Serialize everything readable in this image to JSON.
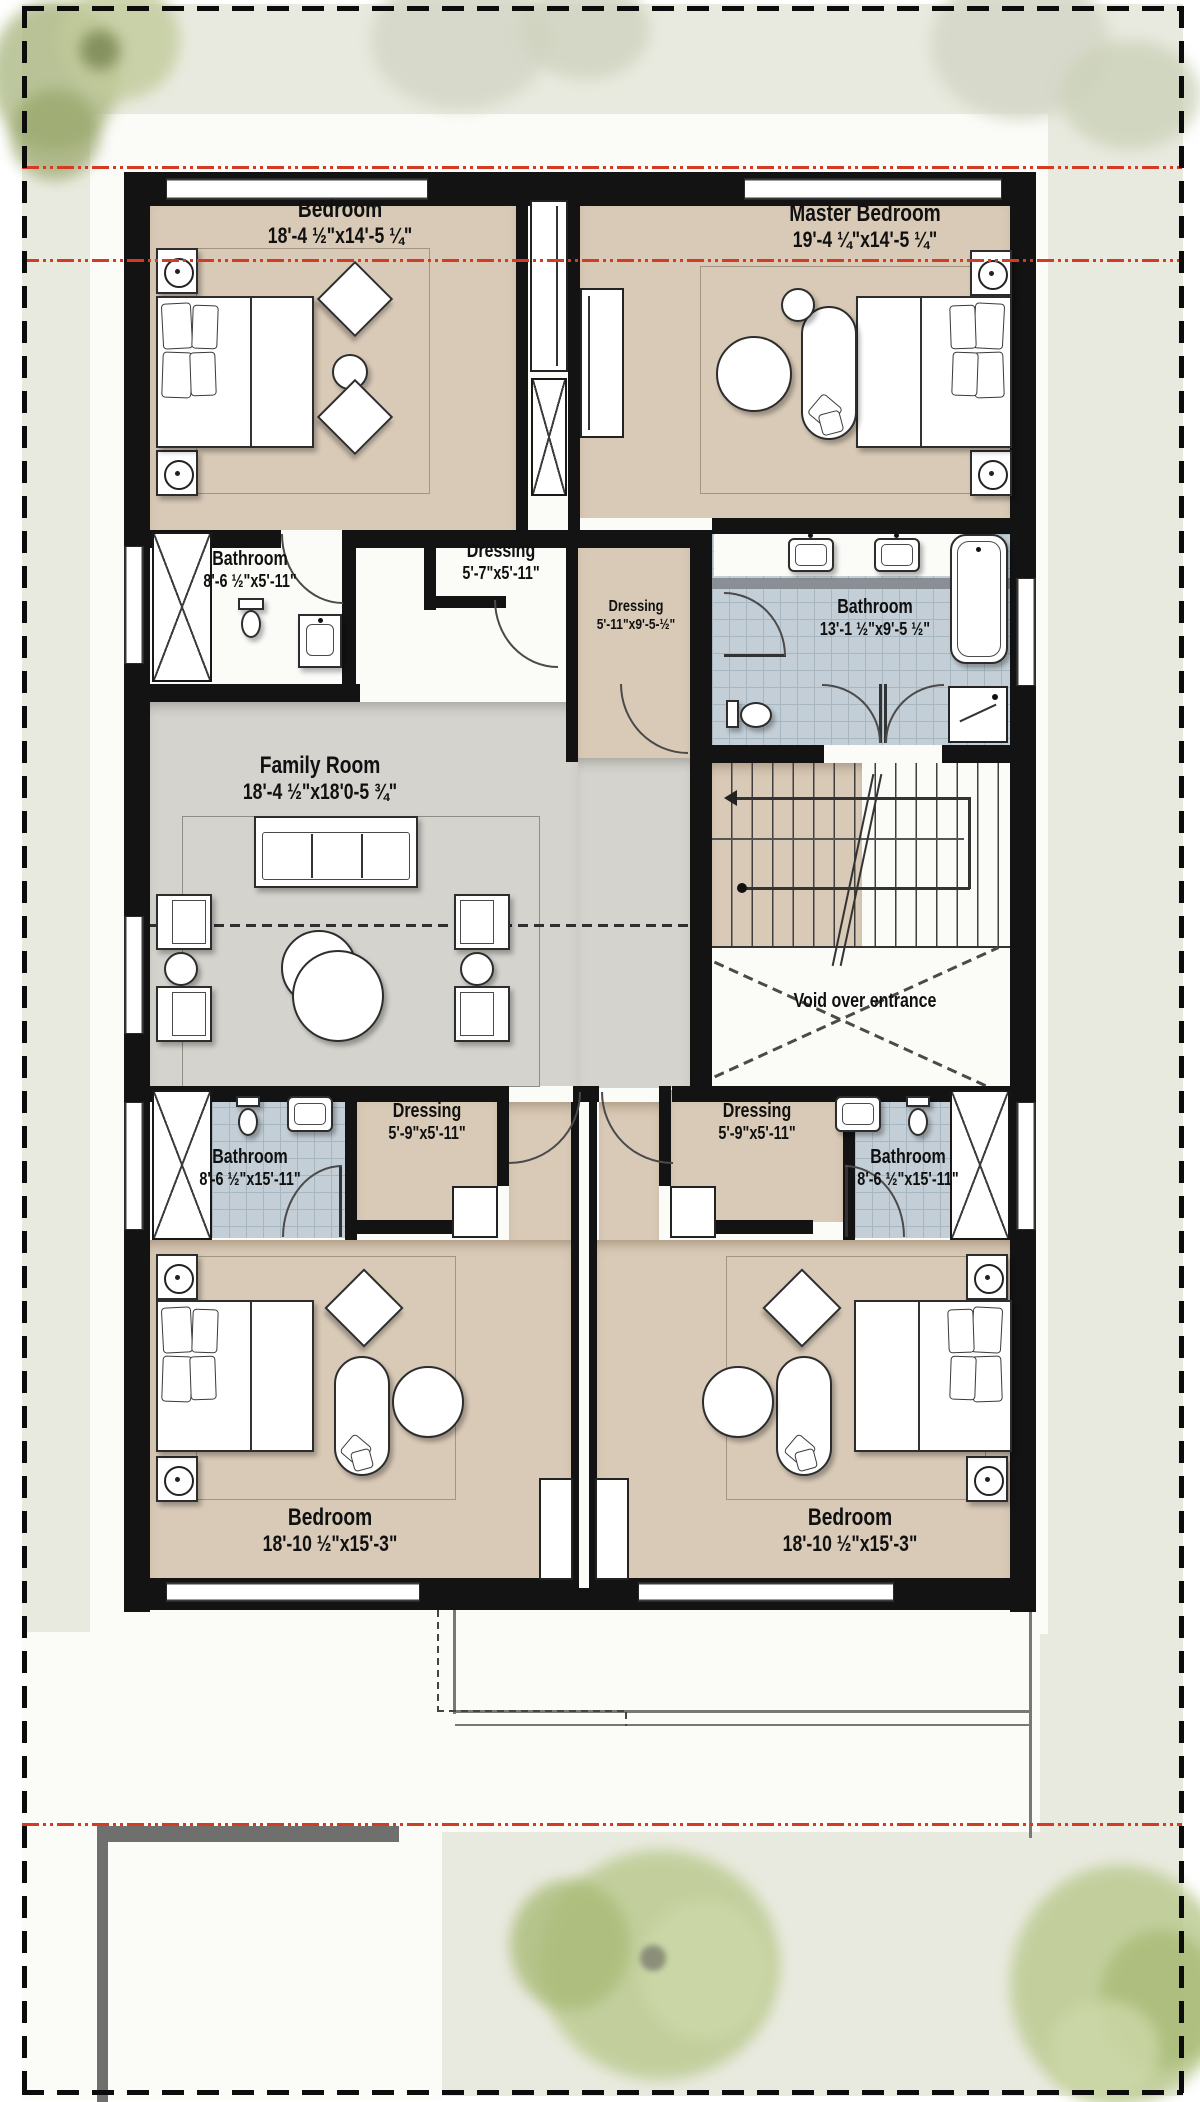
{
  "colors": {
    "wall": "#131313",
    "floor_tan": "#d9cab7",
    "floor_gray": "#d5d3cd",
    "bathroom_tile": "#c3ced6",
    "section_line_red": "#d53a23",
    "tree_green": "#b9c88f",
    "paper": "#e9eadf"
  },
  "rooms": {
    "bedroom_tl": {
      "name": "Bedroom",
      "dims": "18'-4 ½\"x14'-5 ¼\""
    },
    "master": {
      "name": "Master Bedroom",
      "dims": "19'-4 ¼\"x14'-5 ¼\""
    },
    "bath_tl": {
      "name": "Bathroom",
      "dims": "8'-6 ½\"x5'-11\""
    },
    "dressing_top": {
      "name": "Dressing",
      "dims": "5'-7\"x5'-11\""
    },
    "dressing_mid": {
      "name": "Dressing",
      "dims": "5'-11\"x9'-5-½\""
    },
    "bath_master": {
      "name": "Bathroom",
      "dims": "13'-1 ½\"x9'-5 ½\""
    },
    "family": {
      "name": "Family Room",
      "dims": "18'-4 ½\"x18'0-5 ¾\""
    },
    "void": {
      "name": "Void over entrance"
    },
    "dressing_bl": {
      "name": "Dressing",
      "dims": "5'-9\"x5'-11\""
    },
    "bath_bl": {
      "name": "Bathroom",
      "dims": "8'-6 ½\"x15'-11\""
    },
    "dressing_br": {
      "name": "Dressing",
      "dims": "5'-9\"x5'-11\""
    },
    "bath_br": {
      "name": "Bathroom",
      "dims": "8'-6 ½\"x15'-11\""
    },
    "bedroom_bl": {
      "name": "Bedroom",
      "dims": "18'-10 ½\"x15'-3\""
    },
    "bedroom_br": {
      "name": "Bedroom",
      "dims": "18'-10 ½\"x15'-3\""
    }
  }
}
